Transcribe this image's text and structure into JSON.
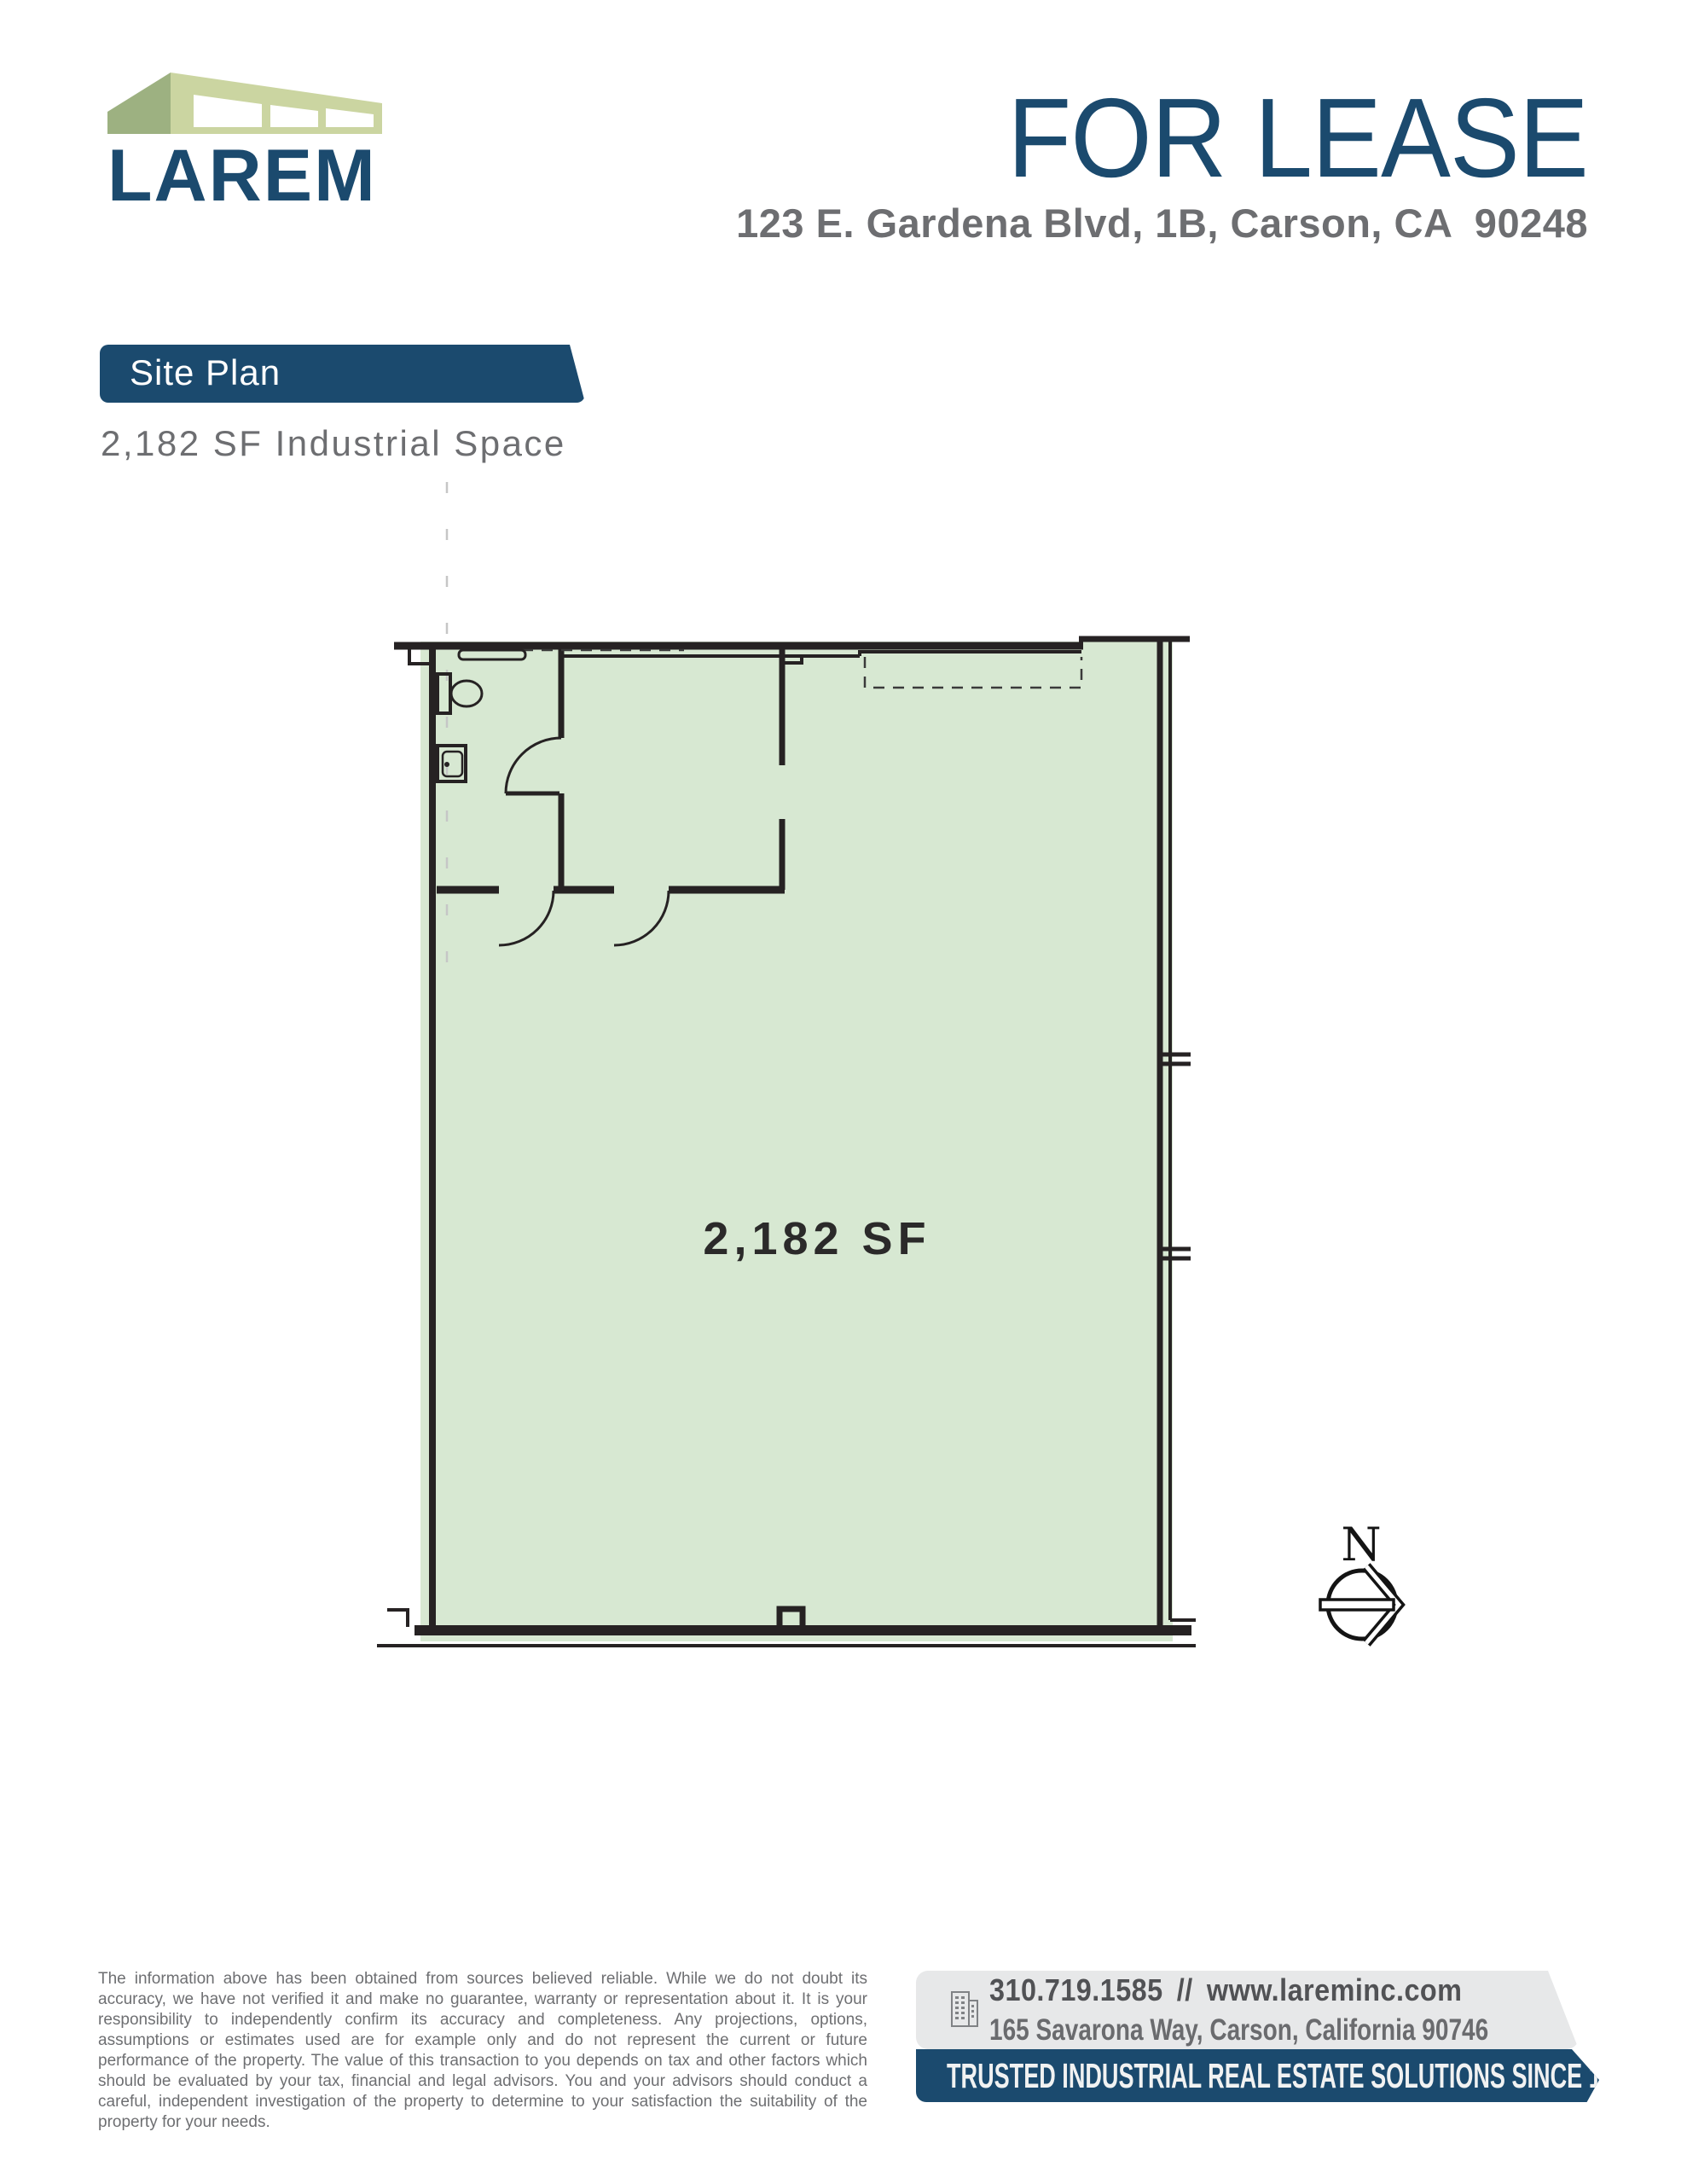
{
  "brand": {
    "name": "LAREM"
  },
  "header": {
    "status": "FOR LEASE",
    "address": "123 E. Gardena Blvd, 1B, Carson, CA  90248"
  },
  "site_plan": {
    "banner": "Site Plan",
    "subtitle": "2,182 SF Industrial Space"
  },
  "floor_plan": {
    "area_label": "2,182 SF",
    "north": "N"
  },
  "footer": {
    "disclaimer": "The information above has been obtained from sources believed reliable. While we do not doubt its accuracy, we have not verified it and make no guarantee, warranty or representation about it. It is your responsibility to independently confirm its accuracy and completeness. Any projections, options, assumptions or estimates used are for example only and do not represent the current or future performance of the property. The value of this transaction to you depends on tax and other factors which should be evaluated by your tax, financial and legal advisors. You and your advisors should conduct a careful, independent investigation of the property to determine to your satisfaction the suitability of the property for your needs.",
    "phone": "310.719.1585",
    "separator": "//",
    "website": "www.lareminc.com",
    "office_address": "165 Savarona Way, Carson, California 90746",
    "tagline": "TRUSTED INDUSTRIAL REAL ESTATE SOLUTIONS SINCE 1993"
  },
  "colors": {
    "brand_blue": "#1B4A6E",
    "text_gray": "#6D6E71",
    "dark_gray": "#515255",
    "plan_fill": "#D7E8D2",
    "plan_line": "#262223",
    "logo_green_light": "#CBD5A1",
    "logo_green_dark": "#9DB181",
    "panel_gray": "#E7E8E9",
    "tagline_text": "#F1F2F2",
    "dash_light": "#C6C6C6"
  }
}
